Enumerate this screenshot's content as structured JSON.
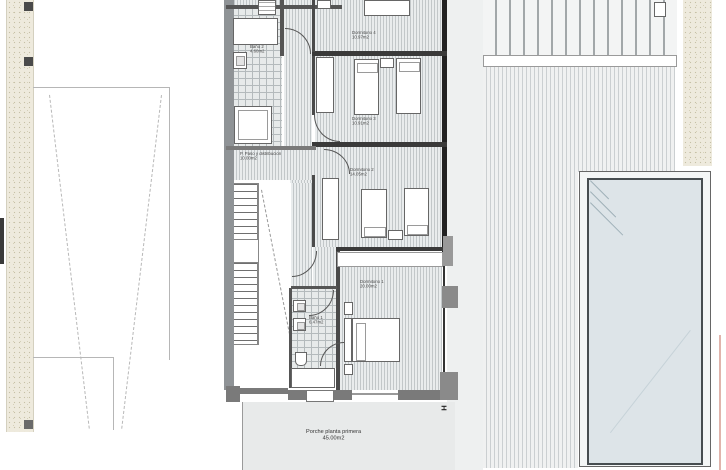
{
  "rooms": {
    "dorm4": {
      "name": "Dormitorio 4",
      "area": "10.97m2"
    },
    "dorm3": {
      "name": "Dormitorio 3",
      "area": "10.91m2"
    },
    "dorm2": {
      "name": "Dormitorio 2",
      "area": "14.05m2"
    },
    "dorm1": {
      "name": "Dormitorio 1",
      "area": "20.00m2"
    },
    "bath1": {
      "name": "Baño 1",
      "area": "6.47m2"
    },
    "bath2": {
      "name": "Baño 2",
      "area": "4.60m2"
    },
    "hall": {
      "name": "P. Paso y distribución",
      "area": "10.00m2"
    },
    "porch": {
      "name": "Porche planta primera",
      "area": "45.00m2"
    }
  },
  "symbols": {
    "section_marker": "H"
  },
  "colors": {
    "wall_dark": "#222222",
    "wall_grey": "#8f9396",
    "hatch_line": "#c2c7c9",
    "pool_water": "#dde4e8",
    "gravel_beige": "#eeeadd",
    "porch_grey": "#e8eaea"
  }
}
